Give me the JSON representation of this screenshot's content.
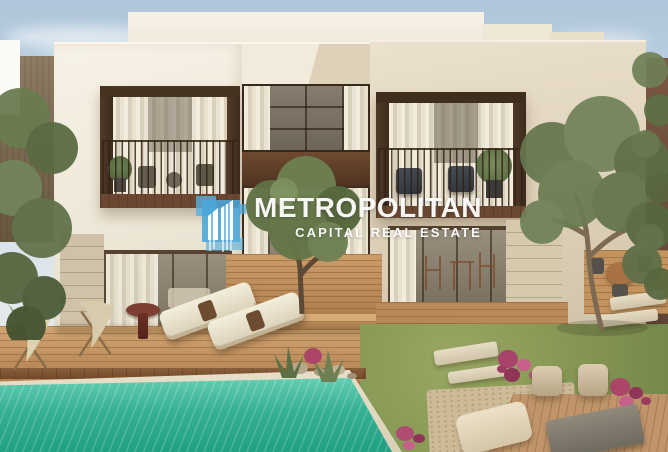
{
  "watermark": {
    "brand": "METROPOLITAN",
    "tagline": "CAPITAL REAL ESTATE",
    "text_color": "#ffffff",
    "logo": {
      "name": "metropolitan-buildings-logo",
      "color": "#4ba6d9"
    }
  },
  "scene": {
    "type": "architectural-rendering",
    "subject": "Two-storey modern villa with recessed balconies, wooden pool deck, garden and turquoise swimming pool",
    "palette": {
      "sky": "#c2d4e2",
      "wall_white": "#f4efe4",
      "wall_beige": "#ddd2bd",
      "wood_dark_brown": "#55402e",
      "deck_wood": "#c2945f",
      "pool_water": "#35b093",
      "grass": "#8a9a57",
      "flowers_magenta": "#ab4668",
      "stone_travertine": "#cfc2a8"
    }
  }
}
